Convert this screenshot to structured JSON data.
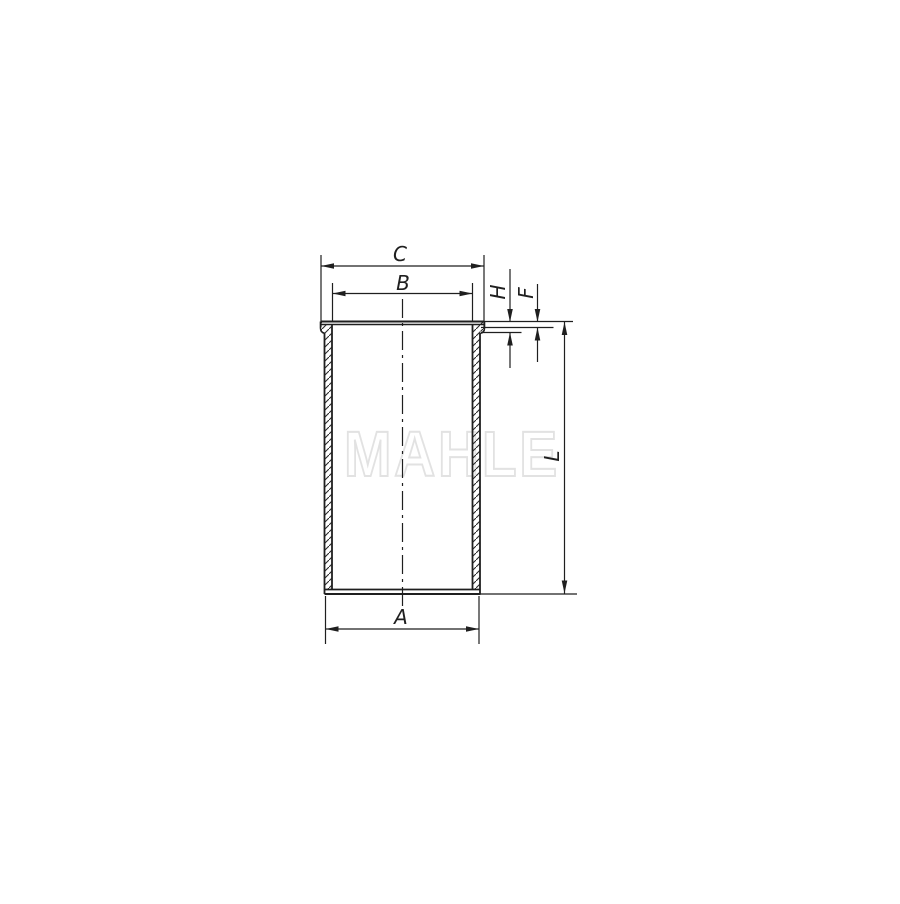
{
  "drawing": {
    "watermark": "MAHLE",
    "line_color": "#1f1f1f",
    "watermark_color": "#e2e2e2",
    "background_color": "#ffffff",
    "labels": {
      "c": "C",
      "b": "B",
      "a": "A",
      "h": "H",
      "f": "F",
      "l": "L"
    }
  }
}
